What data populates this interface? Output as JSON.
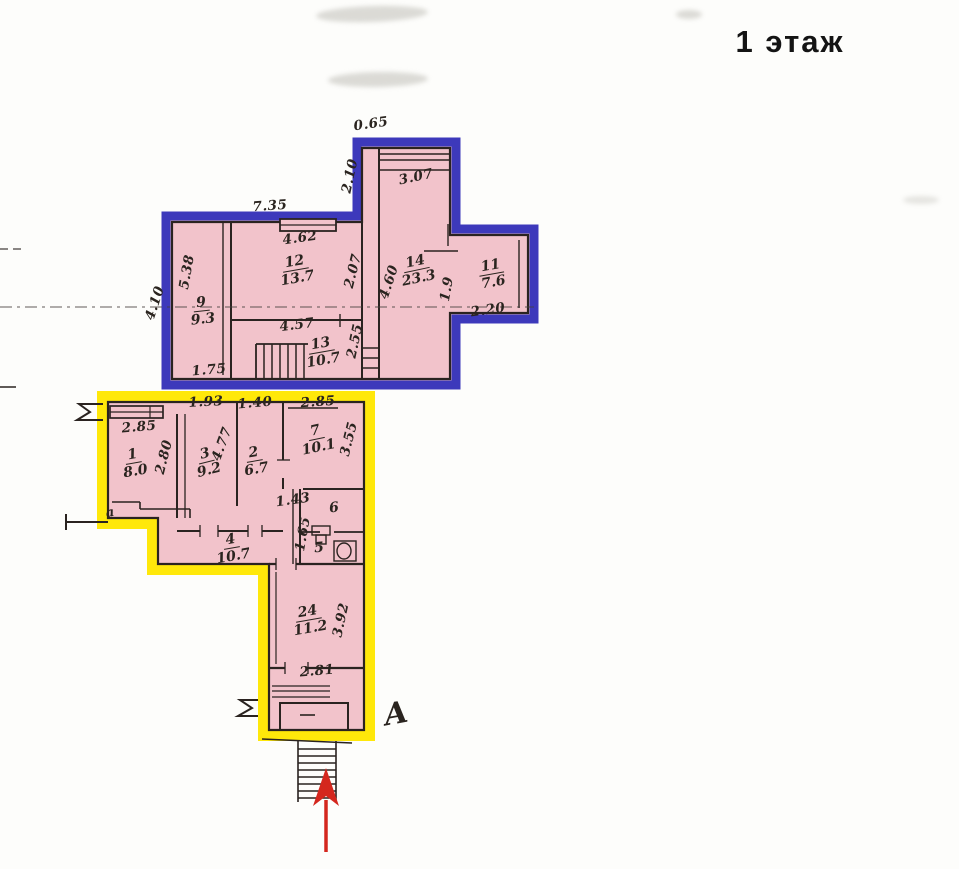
{
  "meta": {
    "floor_title": "1 этаж"
  },
  "colors": {
    "blue_outline": "#3d39bb",
    "yellow_outline": "#ffe80a",
    "room_fill": "#f2c3cb",
    "wall": "#2a2320",
    "entrance_arrow": "#d4271e"
  },
  "rooms": {
    "r9": {
      "num": "9",
      "area": "9.3"
    },
    "r12": {
      "num": "12",
      "area": "13.7"
    },
    "r13": {
      "num": "13",
      "area": "10.7"
    },
    "r14": {
      "num": "14",
      "area": "23.3"
    },
    "r11": {
      "num": "11",
      "area": "7.6"
    },
    "r1": {
      "num": "1",
      "area": "8.0"
    },
    "r3": {
      "num": "3",
      "area": "9.2"
    },
    "r2": {
      "num": "2",
      "area": "6.7"
    },
    "r7": {
      "num": "7",
      "area": "10.1"
    },
    "r6": {
      "num": "6"
    },
    "r5": {
      "num": "5"
    },
    "r4": {
      "num": "4",
      "area": "10.7"
    },
    "r24": {
      "num": "24",
      "area": "11.2"
    },
    "closet": {
      "num": "а"
    }
  },
  "dimensions": {
    "top_offset": "0.65",
    "room14_width_top": "3.07",
    "room14_left_top": "2.10",
    "blue_top_width": "7.35",
    "room12_window": "4.62",
    "room12_right": "2.07",
    "room14_left": "4.60",
    "room9_left": "5.38",
    "blue_left_outside": "4.10",
    "room9_bottom": "1.75",
    "corridor13_top": "4.57",
    "room13_right": "2.55",
    "room11_opening": "1.9",
    "room11_bottom": "2.20",
    "room3_top": "1.93",
    "room2_top": "1.40",
    "room1_window": "2.85",
    "room7_top": "2.85",
    "room1_right": "2.80",
    "room3_right": "4.77",
    "room7_right": "3.55",
    "room6_door": "1.43",
    "room56_left": "1.65",
    "room24_right": "3.92",
    "room24_bottom": "2.81"
  },
  "annotations": {
    "axis_letter": "А"
  }
}
